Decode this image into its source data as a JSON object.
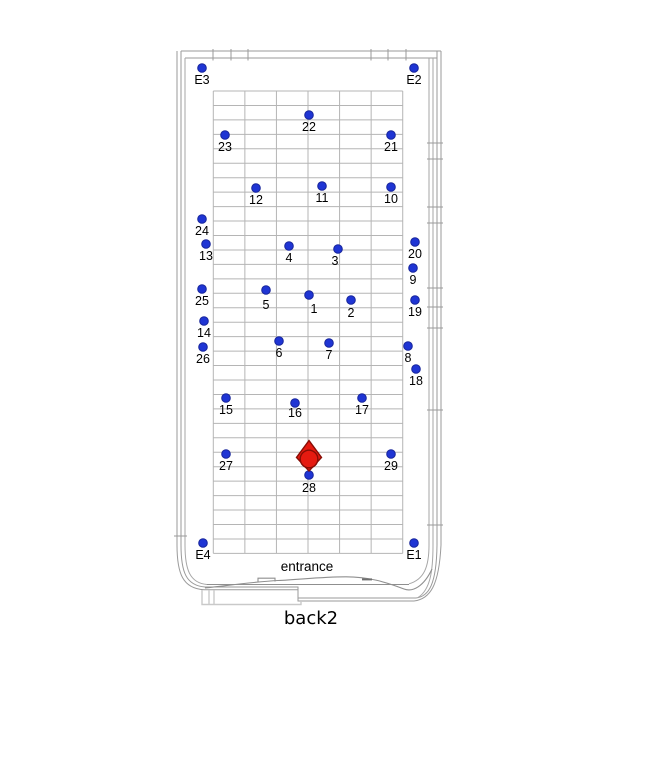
{
  "caption": "back2",
  "entrance_label": "entrance",
  "colors": {
    "node_fill": "#1f35d4",
    "node_stroke": "#16249b",
    "marker_fill": "#e51a10",
    "marker_stroke": "#870d05",
    "grid": "#b5b5b5",
    "wall": "#9a9a9a",
    "text": "#000000"
  },
  "grid": {
    "x": 213.3,
    "y": 91,
    "cols": 6,
    "col_width": 31.57,
    "rows": 32,
    "row_height": 14.45
  },
  "node_style": {
    "radius": 4.3,
    "label_dy": 16
  },
  "marker": {
    "x": 309,
    "y": 459,
    "shape": "diamond-with-circle",
    "near_node": "28"
  },
  "nodes": [
    {
      "label": "E3",
      "type": "corner",
      "x": 202,
      "y": 68
    },
    {
      "label": "E2",
      "type": "corner",
      "x": 414,
      "y": 68
    },
    {
      "label": "E4",
      "type": "corner",
      "x": 203,
      "y": 543
    },
    {
      "label": "E1",
      "type": "corner",
      "x": 414,
      "y": 543
    },
    {
      "label": "22",
      "type": "point",
      "x": 309,
      "y": 115
    },
    {
      "label": "23",
      "type": "point",
      "x": 225,
      "y": 135
    },
    {
      "label": "21",
      "type": "point",
      "x": 391,
      "y": 135
    },
    {
      "label": "12",
      "type": "point",
      "x": 256,
      "y": 188
    },
    {
      "label": "11",
      "type": "point",
      "x": 322,
      "y": 186
    },
    {
      "label": "10",
      "type": "point",
      "x": 391,
      "y": 187
    },
    {
      "label": "24",
      "type": "point",
      "x": 202,
      "y": 219
    },
    {
      "label": "13",
      "type": "point",
      "x": 206,
      "y": 244
    },
    {
      "label": "4",
      "type": "point",
      "x": 289,
      "y": 246
    },
    {
      "label": "3",
      "type": "point",
      "x": 338,
      "y": 249,
      "dx": -3
    },
    {
      "label": "20",
      "type": "point",
      "x": 415,
      "y": 242
    },
    {
      "label": "9",
      "type": "point",
      "x": 413,
      "y": 268
    },
    {
      "label": "25",
      "type": "point",
      "x": 202,
      "y": 289
    },
    {
      "label": "5",
      "type": "point",
      "x": 266,
      "y": 290,
      "dy": 19
    },
    {
      "label": "1",
      "type": "point",
      "x": 309,
      "y": 295,
      "dx": 5,
      "dy": 18
    },
    {
      "label": "2",
      "type": "point",
      "x": 351,
      "y": 300,
      "dy": 17
    },
    {
      "label": "19",
      "type": "point",
      "x": 415,
      "y": 300
    },
    {
      "label": "14",
      "type": "point",
      "x": 204,
      "y": 321
    },
    {
      "label": "26",
      "type": "point",
      "x": 203,
      "y": 347
    },
    {
      "label": "6",
      "type": "point",
      "x": 279,
      "y": 341
    },
    {
      "label": "7",
      "type": "point",
      "x": 329,
      "y": 343
    },
    {
      "label": "8",
      "type": "point",
      "x": 408,
      "y": 346
    },
    {
      "label": "18",
      "type": "point",
      "x": 416,
      "y": 369
    },
    {
      "label": "15",
      "type": "point",
      "x": 226,
      "y": 398
    },
    {
      "label": "16",
      "type": "point",
      "x": 295,
      "y": 403,
      "dy": 14
    },
    {
      "label": "17",
      "type": "point",
      "x": 362,
      "y": 398
    },
    {
      "label": "27",
      "type": "point",
      "x": 226,
      "y": 454
    },
    {
      "label": "29",
      "type": "point",
      "x": 391,
      "y": 454
    },
    {
      "label": "28",
      "type": "point",
      "x": 309,
      "y": 475,
      "dy": 17
    }
  ]
}
